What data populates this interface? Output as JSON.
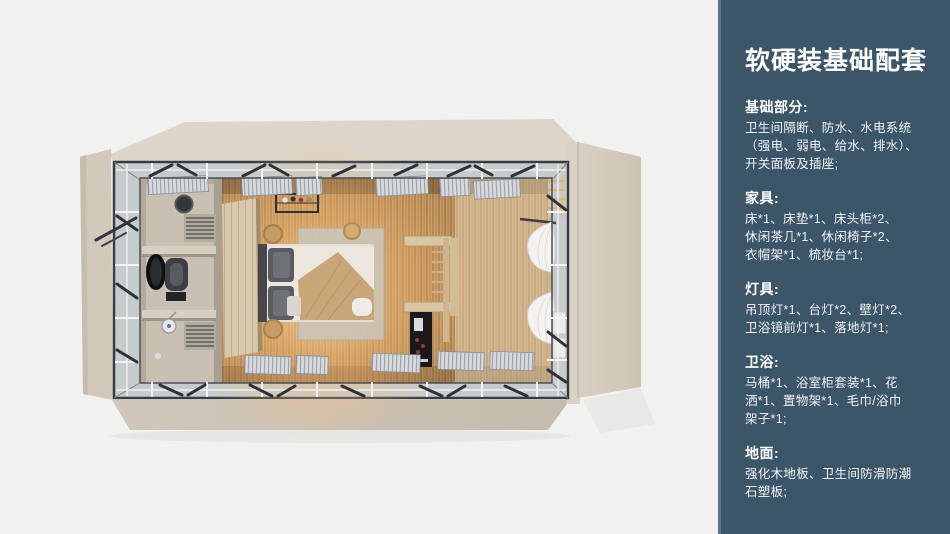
{
  "sidebar": {
    "title": "软硬装基础配套",
    "background": "#3b5569",
    "edge_color": "#5d7384",
    "text_color": "#ffffff",
    "sections": [
      {
        "label": "基础部分:",
        "body": "卫生间隔断、防水、水电系统\n（强电、弱电、给水、排水）、\n开关面板及插座;"
      },
      {
        "label": "家具:",
        "body": "床*1、床垫*1、床头柜*2、\n休闲茶几*1、休闲椅子*2、\n衣帽架*1、梳妆台*1;"
      },
      {
        "label": "灯具:",
        "body": "吊顶灯*1、台灯*2、壁灯*2、\n卫浴镜前灯*1、落地灯*1;"
      },
      {
        "label": "卫浴:",
        "body": "马桶*1、浴室柜套装*1、花\n洒*1、置物架*1、毛巾/浴巾\n架子*1;"
      },
      {
        "label": "地面:",
        "body": "强化木地板、卫生间防滑防潮\n石塑板;"
      }
    ]
  },
  "floorplan": {
    "description": "top-down 3D render of a container guest room: bathroom at left, double bed at center, lounge area with curtains at right, opened louver windows around the perimeter",
    "colors": {
      "background": "#f1f1f0",
      "shell_roof": "#ddd5c9",
      "shell_side": "#d2c9bb",
      "frame_dark": "#383d43",
      "glass_band": "#c6cccd",
      "wood_floor": "#c0955f",
      "warm_glow": "#ffd696",
      "bathroom": "#c8c1b3",
      "bedding": "#ebe6de",
      "throw_blanket": "#c9a678",
      "pillow": "#595c61",
      "curtain": "#f3f2f0"
    }
  }
}
